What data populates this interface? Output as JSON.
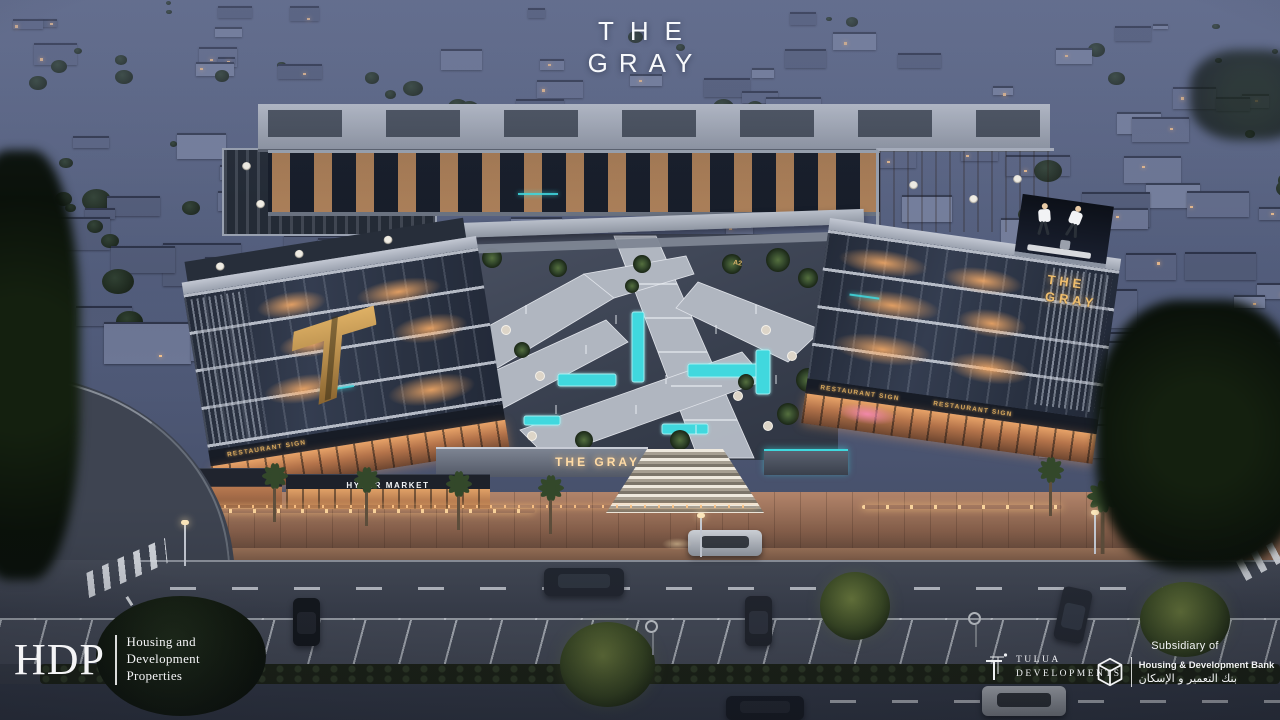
{
  "watermark": {
    "line1": "THE",
    "line2": "GRAY"
  },
  "signs": {
    "building_sign_line1": "THE",
    "building_sign_line2": "GRAY",
    "plaza_sign": "THE GRAY",
    "hyper_market": "HYPER MARKET",
    "restaurant_placeholder": "RESTAURANT SIGN",
    "zone_label": "A2"
  },
  "footer": {
    "hdp": {
      "abbr": "HDP",
      "lines": [
        "Housing and",
        "Development",
        "Properties"
      ]
    },
    "tulua": {
      "line1": "TULUA",
      "line2": "DEVELOPMENTS"
    },
    "hdb": {
      "subsidiary": "Subsidiary of",
      "name_en": "Housing & Development Bank",
      "name_ar": "بنك التعمير و الإسكان"
    }
  },
  "palette": {
    "sign_gold": "#e5b266",
    "pool_teal": "#45dde3",
    "window_warm": "#ffbe7d",
    "dusk_blue": "#5d6883"
  }
}
